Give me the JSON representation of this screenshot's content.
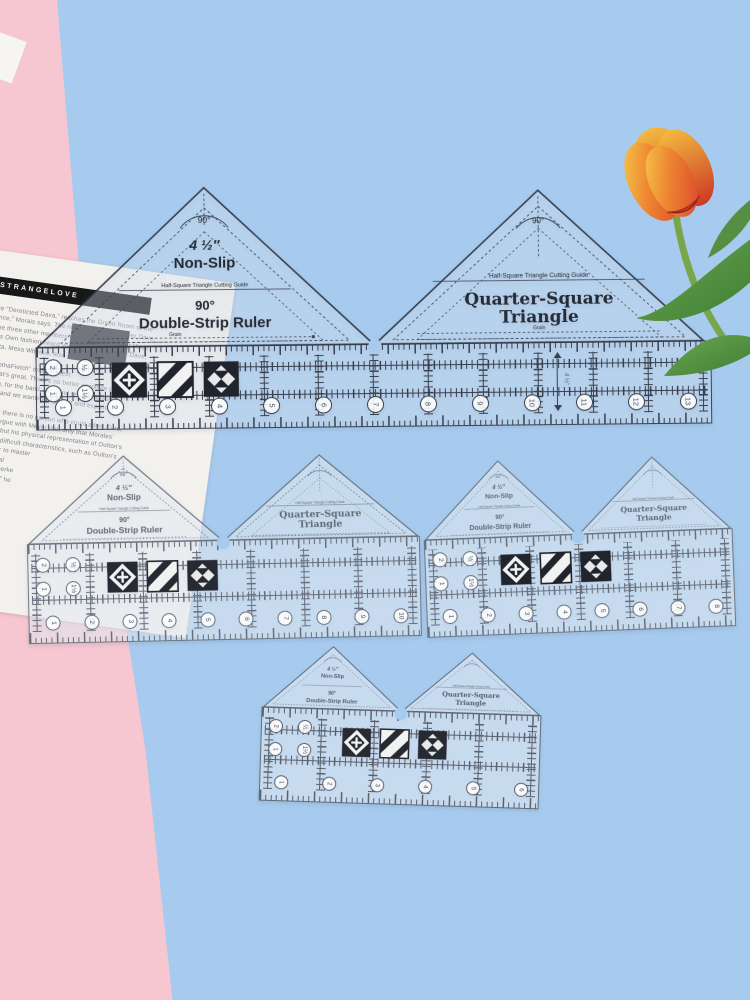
{
  "scene": {
    "backdrop_blue": "#a7cbee",
    "backdrop_pink": "#f6c7d0",
    "paper_white": "#f3f1ee",
    "ruler_ink_dark": "#3a414e",
    "ruler_ink_gray": "#68707c",
    "tulip_colors": [
      "#f6d44e",
      "#ee8632",
      "#d8402a"
    ],
    "leaf_green": "#55933f",
    "decor_flower": "tulip"
  },
  "paper": {
    "masthead": "STRANGELOVE",
    "lines": [
      "ange “Dereticted Dava,” reaches the Green Room of the",
      "“Cance,” Morais says. The night crowd is in leather Dave,",
      "by the three other members of Strangelove Beast Mode,",
      "Curtis Own fashion heard vocalists on the Matter Dave,",
      "Ecosta, Mesa Wheelie, also launch of ‘Aces’ Minor layers,",
      "list “bothaFietch” on the tellest.",
      "and that's great. There's no better accolade than",
      "nothing, for the band, the band refuses to sell,",
      "project and we wanted to grow it and expanded on",
      "said that there is no person who could admit Cure,",
      "tried to argue with Meyer. Not only that Morales’",
      "mention, but his physical representation of Oulton's",
      "therefore difficult characteristics, such as Oulton's",
      "tion a year to master",
      "Mardou real",
      "the hand, perke",
      "“incratering” he"
    ]
  },
  "ruler_labels": {
    "angle": "90°",
    "size": "4 ½″",
    "non_slip": "Non-Slip",
    "cutting_guide": "Half-Square Triangle Cutting Guide",
    "double_strip": "Double-Strip Ruler",
    "quarter_square_1": "Quarter-Square",
    "quarter_square_2": "Triangle",
    "grain": "Grain"
  },
  "rulers": {
    "large": {
      "corner_numbers": [
        "2",
        "½",
        "1",
        "1½"
      ],
      "scale_numbers": [
        "1",
        "2",
        "3",
        "4",
        "5",
        "6",
        "7",
        "8",
        "9",
        "10",
        "11",
        "12",
        "13"
      ]
    },
    "medium_left": {
      "corner_numbers": [
        "2",
        "½",
        "1",
        "1½"
      ],
      "scale_numbers": [
        "1",
        "2",
        "3",
        "4",
        "5",
        "6",
        "7",
        "8",
        "9",
        "10"
      ]
    },
    "medium_right": {
      "corner_numbers": [
        "2",
        "½",
        "1",
        "1½"
      ],
      "scale_numbers": [
        "1",
        "2",
        "3",
        "4",
        "5",
        "6",
        "7",
        "8"
      ]
    },
    "small": {
      "corner_numbers": [
        "2",
        "½",
        "1",
        "1½"
      ],
      "scale_numbers": [
        "1",
        "2",
        "3",
        "4",
        "5",
        "6"
      ]
    }
  }
}
